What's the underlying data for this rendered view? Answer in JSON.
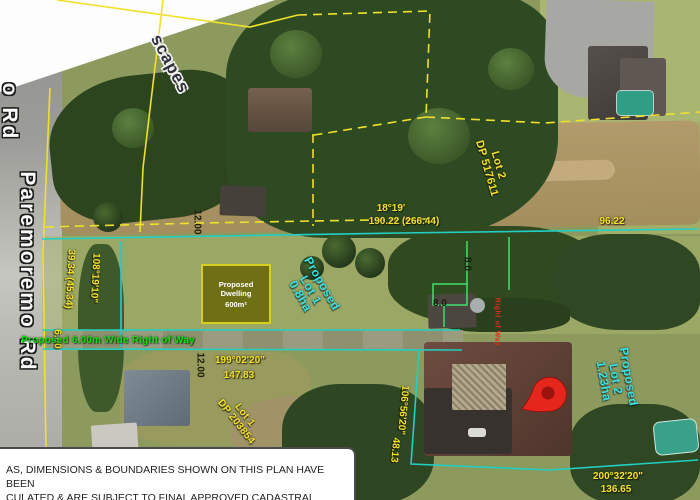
{
  "plan": {
    "road": {
      "name": "Paremoremo Rd",
      "name_partial": "o Rd"
    },
    "watermark": "scapes",
    "lots": {
      "proposed_lot_1": {
        "lines": [
          "Proposed",
          "Lot 1",
          "0.8ha"
        ]
      },
      "proposed_lot_2": {
        "lines": [
          "Proposed",
          "Lot 2",
          "1.23ha"
        ]
      },
      "existing_lot_2": {
        "lines": [
          "Lot 2",
          "DP 517611"
        ]
      },
      "existing_lot_1": {
        "lines": [
          "Lot 1",
          "DP 203854"
        ]
      }
    },
    "dwelling": {
      "title": "Proposed Dwelling",
      "area": "600m²"
    },
    "right_of_way": {
      "label": "Proposed 6.00m Wide Right of Way",
      "red_label": "Right of Way"
    },
    "dimensions": {
      "north_boundary": {
        "bearing": "18°19'",
        "distance": "190.22 (266.44)"
      },
      "north_east": {
        "distance": "96.22"
      },
      "road_frontage": {
        "bearing": "108°19'10\"",
        "distance": "39.34 (45.34)"
      },
      "row_width": {
        "distance": "6.00"
      },
      "south_west": {
        "bearing": "199°02'20\"",
        "distance": "147.83"
      },
      "lot_split": {
        "bearing": "106°56'20\"",
        "distance": "48.13"
      },
      "south_east": {
        "bearing": "200°32'20\"",
        "distance": "136.65"
      },
      "offset_top": {
        "distance": "12.00"
      },
      "offset_bottom": {
        "distance": "12.00"
      },
      "offset_8_v": {
        "distance": "8.0"
      },
      "offset_8_h": {
        "distance": "8.0"
      }
    },
    "disclaimer": {
      "line1": "AS, DIMENSIONS & BOUNDARIES SHOWN ON THIS PLAN HAVE BEEN",
      "line2": "CULATED & ARE SUBJECT TO FINAL APPROVED CADASTRAL",
      "line3": "VEY."
    }
  },
  "colors": {
    "boundary_cyan": "#22cfc4",
    "boundary_green": "#3fdf6e",
    "line_yellow": "#efe12b",
    "label_yellow": "#f2e22e",
    "lot_text_cyan": "#3ae2e2",
    "row_text_green": "#11dc11",
    "red_label": "#d93020",
    "pin_red": "#e5261c",
    "pin_red_dark": "#9c120c",
    "dwelling_fill": "#6f6f15",
    "dwelling_border": "#d8ce20"
  }
}
